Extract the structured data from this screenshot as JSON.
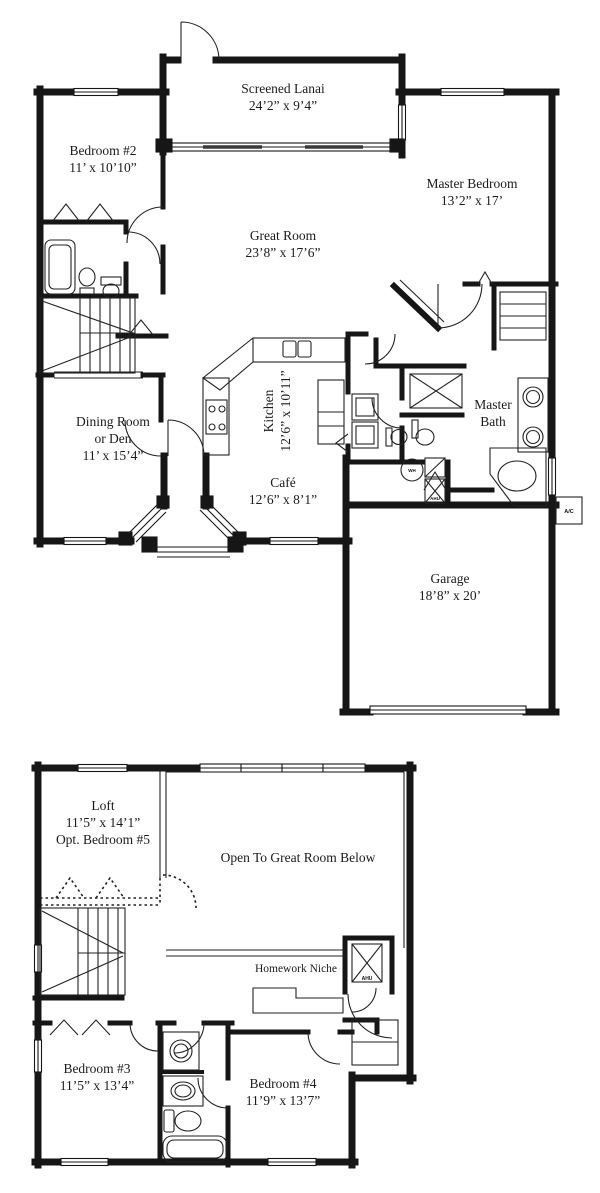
{
  "floor1": {
    "lanai": {
      "name": "Screened Lanai",
      "dims": "24’2” x 9’4”"
    },
    "bedroom2": {
      "name": "Bedroom #2",
      "dims": "11’ x 10’10”"
    },
    "master_bedroom": {
      "name": "Master Bedroom",
      "dims": "13’2” x 17’"
    },
    "great_room": {
      "name": "Great Room",
      "dims": "23’8” x 17’6”"
    },
    "kitchen": {
      "name": "Kitchen",
      "dims": "12’6” x 10’11”"
    },
    "dining": {
      "line1": "Dining Room",
      "line2": "or Den",
      "dims": "11’ x 15’4”"
    },
    "cafe": {
      "name": "Café",
      "dims": "12’6” x 8’1”"
    },
    "master_bath": {
      "line1": "Master",
      "line2": "Bath"
    },
    "garage": {
      "name": "Garage",
      "dims": "18’8” x 20’"
    },
    "labels": {
      "wh": "WH",
      "ahu": "AHU",
      "ac": "A/C"
    }
  },
  "floor2": {
    "loft": {
      "name": "Loft",
      "dims": "11’5” x 14’1”",
      "option": "Opt. Bedroom #5"
    },
    "open_below": {
      "name": "Open To Great Room Below"
    },
    "homework_niche": {
      "name": "Homework Niche"
    },
    "bedroom3": {
      "name": "Bedroom #3",
      "dims": "11’5” x 13’4”"
    },
    "bedroom4": {
      "name": "Bedroom #4",
      "dims": "11’9” x 13’7”"
    },
    "labels": {
      "ahu": "AHU"
    }
  },
  "colors": {
    "wall": "#161616",
    "paper": "#ffffff"
  }
}
